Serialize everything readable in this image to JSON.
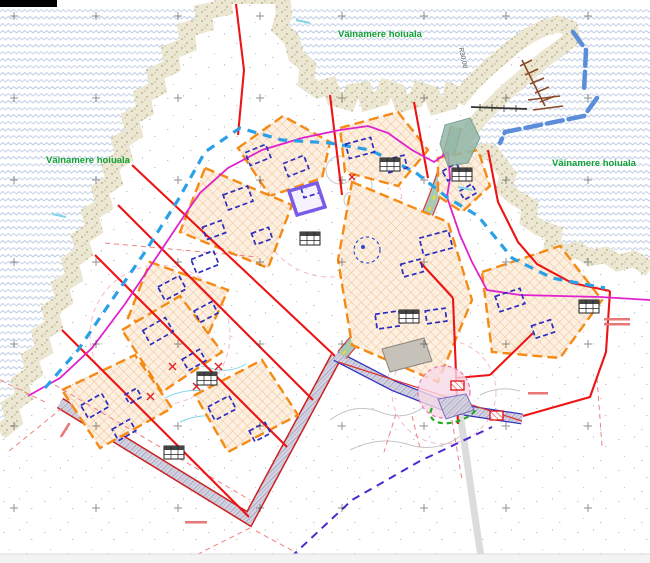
{
  "labels": {
    "protected_area_top": "Väinamere hoiuala",
    "protected_area_left": "Väinamere hoiuala",
    "protected_area_right": "Väinamere hoiuala",
    "radius_dim": "R30,00"
  },
  "colors": {
    "protection_green": "#12a035",
    "shoreline_pink": "#e55f7d",
    "plot_boundary_red": "#ec1414",
    "building_zone_orange": "#f58a14",
    "planned_building_blue": "#2d2dc0",
    "protection_dash_blue": "#29a0e8",
    "restriction_magenta": "#e022cc",
    "water_wave": "#bdcbe4",
    "breakwater_blue": "#5b8dd9",
    "jetty_brown": "#8a4a2a"
  }
}
